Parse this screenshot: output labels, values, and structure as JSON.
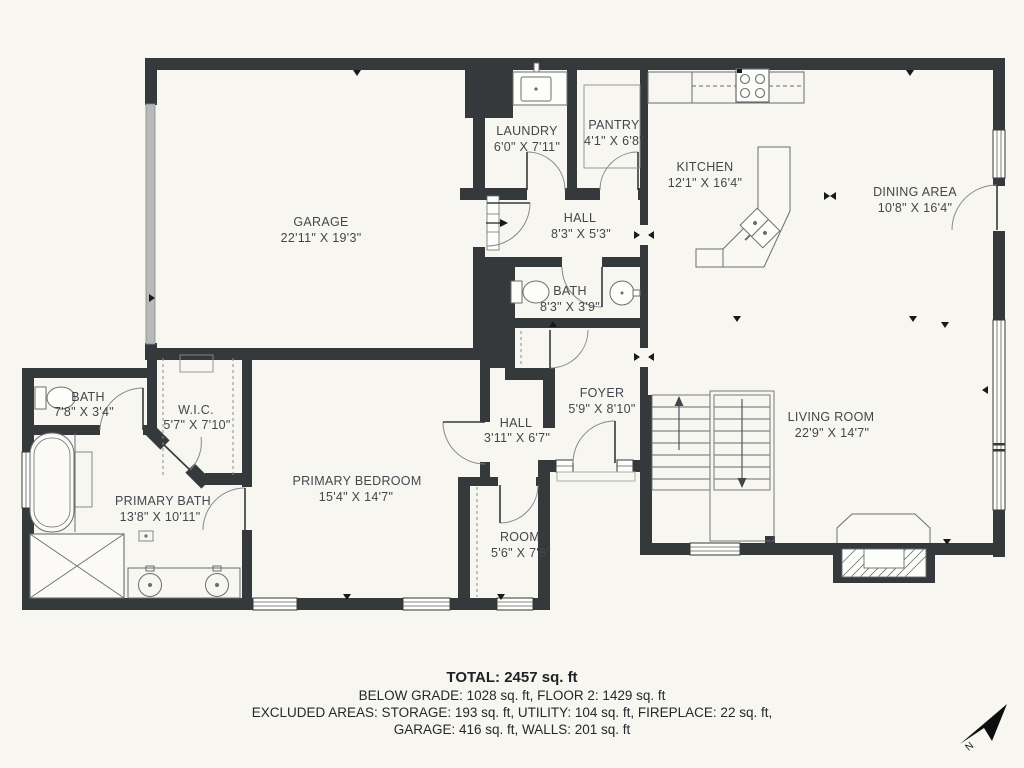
{
  "rooms": [
    {
      "name": "GARAGE",
      "dims": "22'11\" X 19'3\""
    },
    {
      "name": "LAUNDRY",
      "dims": "6'0\" X 7'11\""
    },
    {
      "name": "PANTRY",
      "dims": "4'1\" X 6'8\""
    },
    {
      "name": "KITCHEN",
      "dims": "12'1\" X 16'4\""
    },
    {
      "name": "DINING AREA",
      "dims": "10'8\" X 16'4\""
    },
    {
      "name": "HALL",
      "dims": "8'3\" X 5'3\""
    },
    {
      "name": "BATH",
      "dims": "8'3\" X 3'9\""
    },
    {
      "name": "FOYER",
      "dims": "5'9\" X 8'10\""
    },
    {
      "name": "LIVING ROOM",
      "dims": "22'9\" X 14'7\""
    },
    {
      "name": "BATH",
      "dims": "7'8\" X 3'4\""
    },
    {
      "name": "W.I.C.",
      "dims": "5'7\" X 7'10\""
    },
    {
      "name": "PRIMARY BATH",
      "dims": "13'8\" X 10'11\""
    },
    {
      "name": "PRIMARY BEDROOM",
      "dims": "15'4\" X 14'7\""
    },
    {
      "name": "HALL",
      "dims": "3'11\" X 6'7\""
    },
    {
      "name": "ROOM",
      "dims": "5'6\" X 7'8\""
    }
  ],
  "footer": {
    "total": "TOTAL: 2457 sq. ft",
    "line2": "BELOW GRADE: 1028 sq. ft, FLOOR 2: 1429 sq. ft",
    "line3": "EXCLUDED AREAS: STORAGE: 193 sq. ft, UTILITY: 104 sq. ft, FIREPLACE: 22 sq. ft,",
    "line4": "GARAGE: 416 sq. ft, WALLS: 201 sq. ft"
  },
  "compass": {
    "label": "N"
  },
  "colors": {
    "wall": "#35393c",
    "background": "#f7f6f0",
    "line": "#6a6e72"
  }
}
